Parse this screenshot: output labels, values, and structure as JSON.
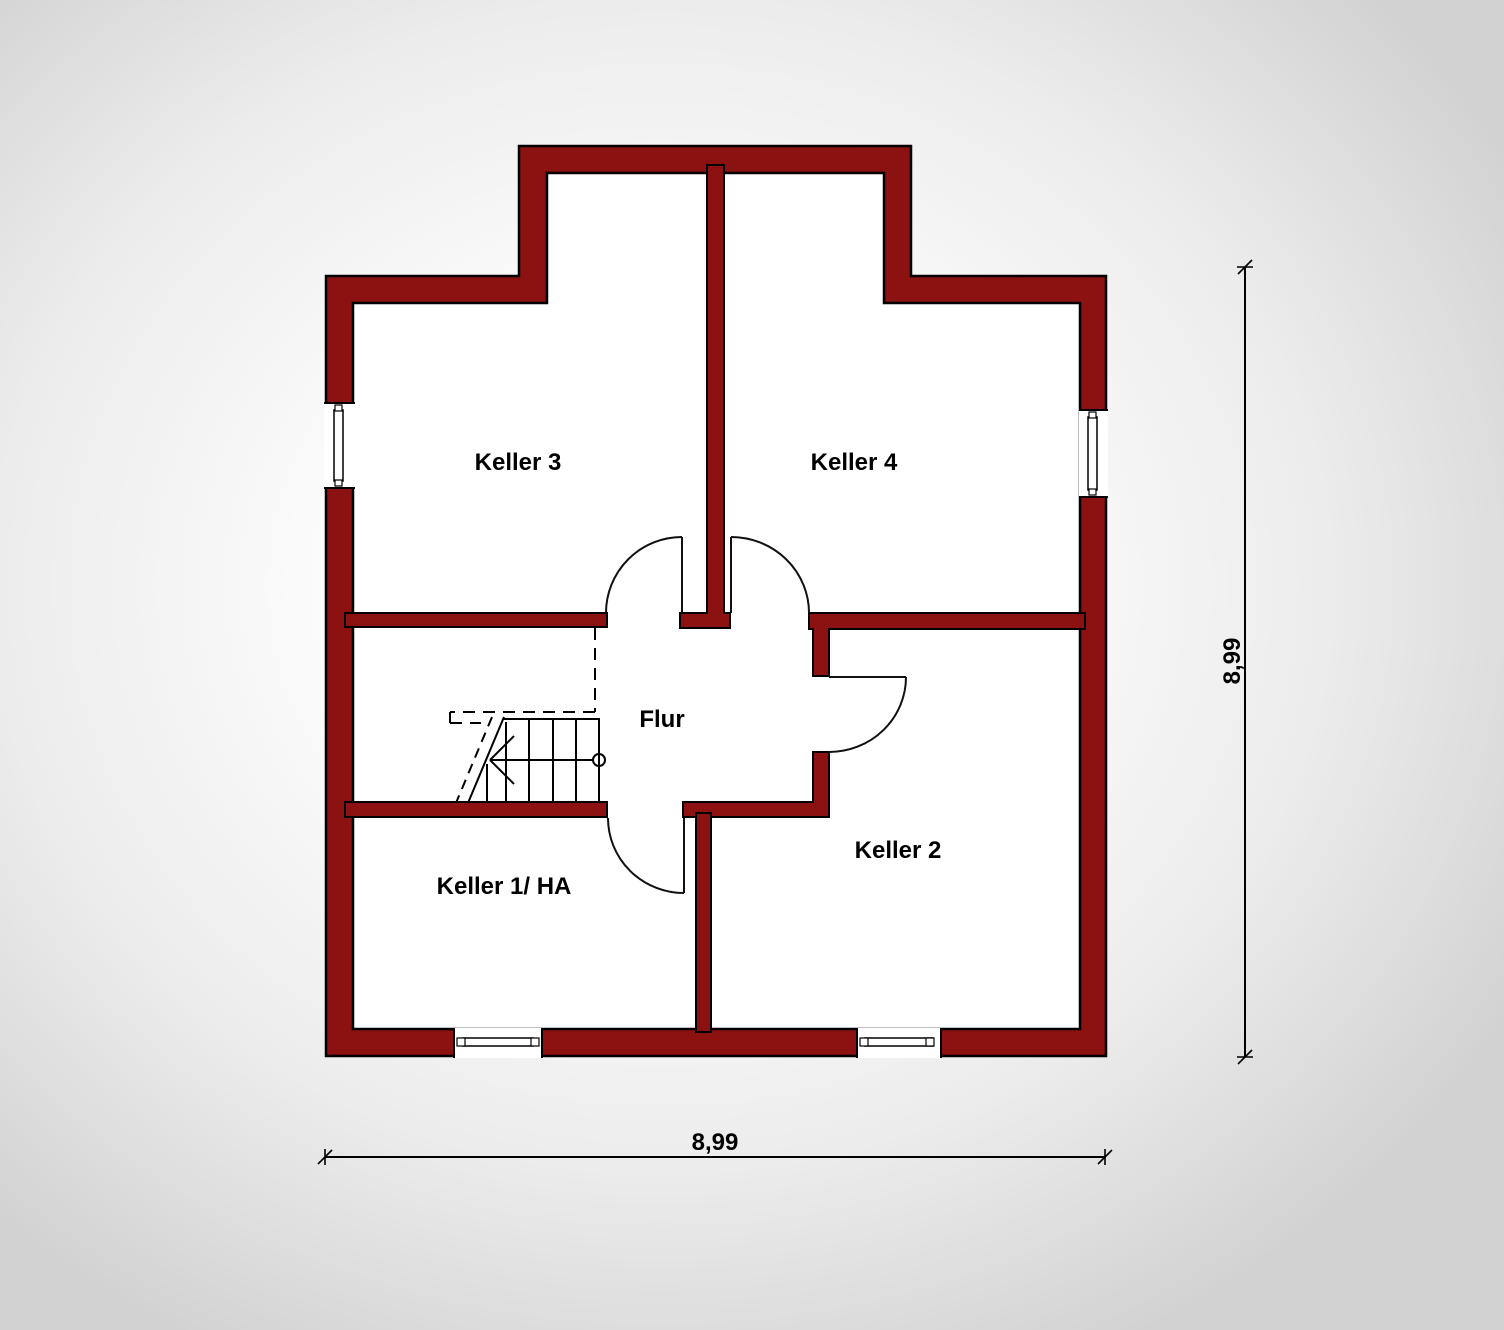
{
  "plan": {
    "type": "floor-plan",
    "floor": "basement",
    "rooms": [
      {
        "label": "Keller 3"
      },
      {
        "label": "Keller 4"
      },
      {
        "label": "Flur"
      },
      {
        "label": "Keller 1/ HA"
      },
      {
        "label": "Keller 2"
      }
    ],
    "dimensions": {
      "width_label": "8,99",
      "height_label": "8,99"
    },
    "colors": {
      "wall": "#8c1111",
      "outline": "#000000",
      "floor": "#ffffff",
      "lines": "#000000"
    }
  }
}
